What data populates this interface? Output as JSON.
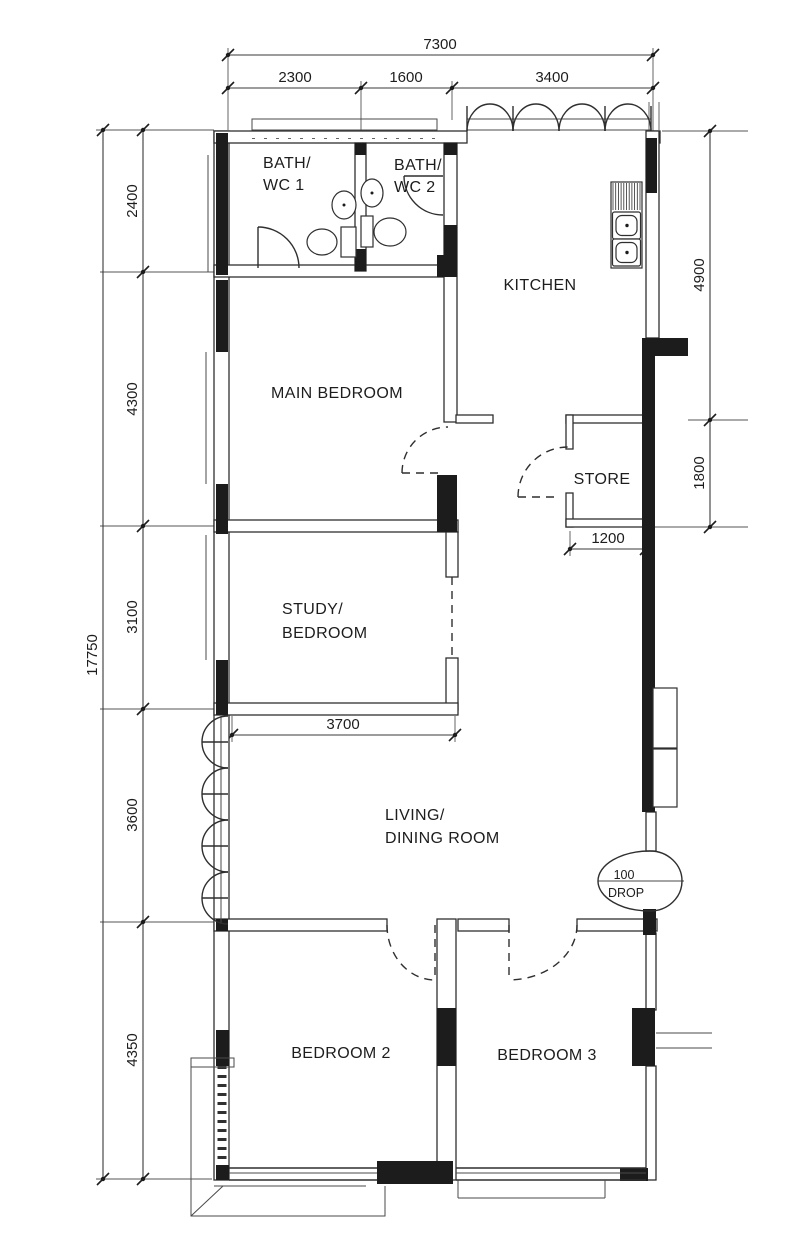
{
  "rooms": {
    "bath1": {
      "line1": "BATH/",
      "line2": "WC 1"
    },
    "bath2": {
      "line1": "BATH/",
      "line2": "WC 2"
    },
    "kitchen": {
      "label": "KITCHEN"
    },
    "main_bedroom": {
      "label": "MAIN BEDROOM"
    },
    "store": {
      "label": "STORE"
    },
    "study": {
      "line1": "STUDY/",
      "line2": "BEDROOM"
    },
    "living": {
      "line1": "LIVING/",
      "line2": "DINING ROOM"
    },
    "bedroom2": {
      "label": "BEDROOM 2"
    },
    "bedroom3": {
      "label": "BEDROOM 3"
    }
  },
  "annotations": {
    "drop": {
      "line1": "100",
      "line2": "DROP"
    }
  },
  "dimensions": {
    "top_total": "7300",
    "top_seg1": "2300",
    "top_seg2": "1600",
    "top_seg3": "3400",
    "left_total": "17750",
    "left_seg1": "2400",
    "left_seg2": "4300",
    "left_seg3": "3100",
    "left_seg4": "3600",
    "left_seg5": "4350",
    "right_seg1": "4900",
    "right_seg2": "1800",
    "store_width": "1200",
    "living_width": "3700"
  }
}
